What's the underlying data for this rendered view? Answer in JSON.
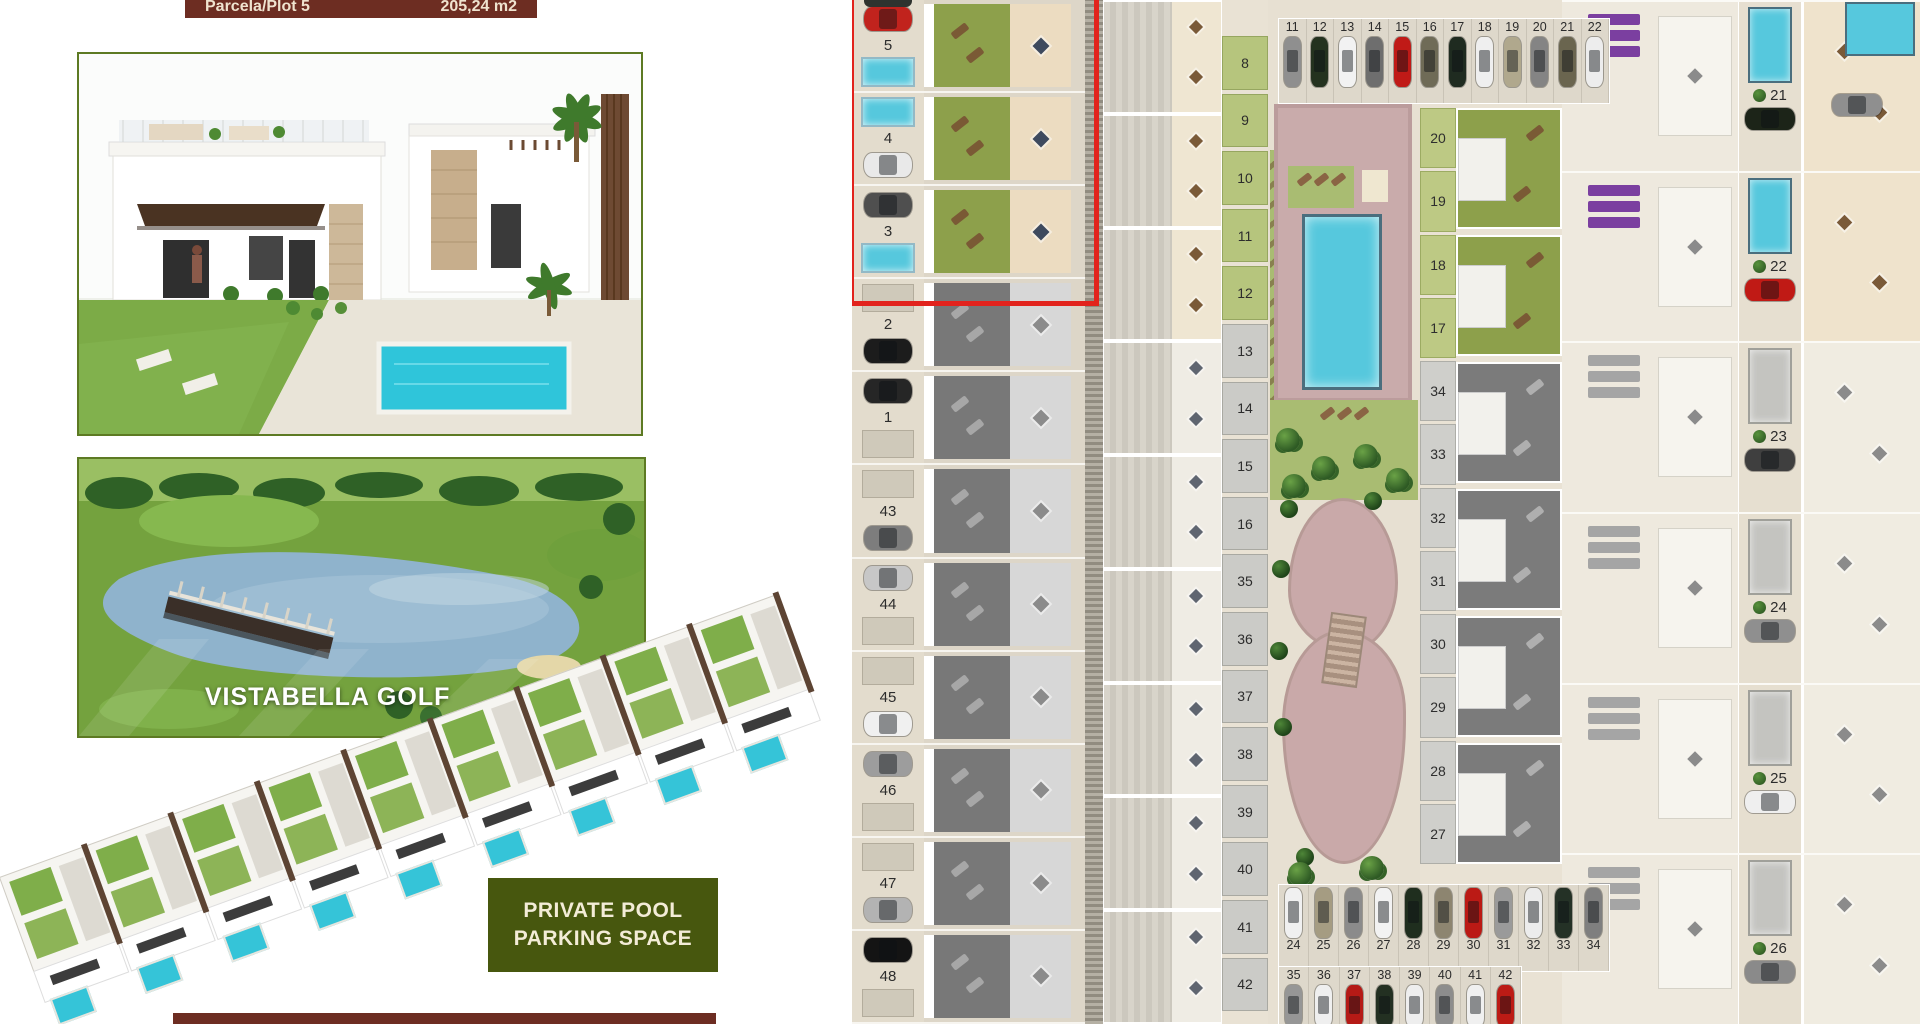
{
  "banners": {
    "top_left": "Parcela/Plot 5",
    "top_right": "205,24 m2"
  },
  "golf": {
    "caption": "VISTABELLA GOLF"
  },
  "green_box": {
    "line1": "PRIVATE POOL",
    "line2": "PARKING SPACE"
  },
  "colors": {
    "accent_red": "#e2231d",
    "banner_maroon": "#6d2d22",
    "photo_border_green": "#5d7a23",
    "pool_cyan": "#56c8dd",
    "garden_green": "#8da04b",
    "plot_cell_green": "#b6c57d",
    "lounger_purple": "#7b3fa0",
    "box_green": "#47570e"
  },
  "icons": {
    "car": "rounded-rect-with-glass",
    "pool": "cyan-rectangle",
    "tree": "green-circle-cluster",
    "lounger": "brown-bar",
    "table": "dark-diamond"
  },
  "plan": {
    "col_a": [
      {
        "label": "5",
        "hl": true,
        "top": "car",
        "bottom": "pool",
        "car": "#c1231d"
      },
      {
        "label": "4",
        "hl": true,
        "top": "pool",
        "bottom": "car",
        "car": "#e9e9e9"
      },
      {
        "label": "3",
        "hl": true,
        "top": "car",
        "bottom": "pool",
        "car": "#4f4f4f"
      },
      {
        "label": "2",
        "top": "pad",
        "bottom": "car",
        "car": "#1c1c1c"
      },
      {
        "label": "1",
        "top": "car",
        "bottom": "pad",
        "car": "#262626"
      },
      {
        "label": "43",
        "top": "pad",
        "bottom": "car",
        "car": "#7d7d7d"
      },
      {
        "label": "44",
        "top": "car",
        "bottom": "pad",
        "car": "#c7c7c7"
      },
      {
        "label": "45",
        "top": "pad",
        "bottom": "car",
        "car": "#f0f0f0"
      },
      {
        "label": "46",
        "top": "car",
        "bottom": "pad",
        "car": "#9d9d9d"
      },
      {
        "label": "47",
        "top": "pad",
        "bottom": "car",
        "car": "#b3b3b3"
      },
      {
        "label": "48",
        "top": "car",
        "bottom": "pad",
        "car": "#141414"
      }
    ],
    "col_b": [
      {
        "warm": true
      },
      {
        "warm": true
      },
      {
        "warm": true
      },
      {},
      {},
      {},
      {},
      {},
      {}
    ],
    "strip_b": [
      {
        "label": "8",
        "g": true
      },
      {
        "label": "9",
        "g": true
      },
      {
        "label": "10",
        "g": true
      },
      {
        "label": "11",
        "g": true
      },
      {
        "label": "12",
        "g": true
      },
      {
        "label": "13"
      },
      {
        "label": "14"
      },
      {
        "label": "15"
      },
      {
        "label": "16"
      },
      {
        "label": "35"
      },
      {
        "label": "36"
      },
      {
        "label": "37"
      },
      {
        "label": "38"
      },
      {
        "label": "39"
      },
      {
        "label": "40"
      },
      {
        "label": "41"
      },
      {
        "label": "42"
      }
    ],
    "top_parking": [
      {
        "label": "11",
        "car": "#8f8f8f"
      },
      {
        "label": "12",
        "car": "#24321f"
      },
      {
        "label": "13",
        "car": "#f2f2f2"
      },
      {
        "label": "14",
        "car": "#6e6e6e"
      },
      {
        "label": "15",
        "car": "#c01a17"
      },
      {
        "label": "16",
        "car": "#6f6b57"
      },
      {
        "label": "17",
        "car": "#1f2b20"
      },
      {
        "label": "18",
        "car": "#efefef"
      },
      {
        "label": "19",
        "car": "#b0a88d"
      },
      {
        "label": "20",
        "car": "#848484"
      },
      {
        "label": "21",
        "car": "#6a654f"
      },
      {
        "label": "22",
        "car": "#ededed"
      }
    ],
    "parking_24_34": [
      {
        "label": "24",
        "car": "#f0f0f0"
      },
      {
        "label": "25",
        "car": "#a59c82"
      },
      {
        "label": "26",
        "car": "#8b8b8b"
      },
      {
        "label": "27",
        "car": "#f2f2f2"
      },
      {
        "label": "28",
        "car": "#1f2e1e"
      },
      {
        "label": "29",
        "car": "#8d8570"
      },
      {
        "label": "30",
        "car": "#bb1a15"
      },
      {
        "label": "31",
        "car": "#9a9a9a"
      },
      {
        "label": "32",
        "car": "#ececec"
      },
      {
        "label": "33",
        "car": "#243126"
      },
      {
        "label": "34",
        "car": "#7f7f7f"
      }
    ],
    "parking_35_42": [
      {
        "label": "35",
        "car": "#969696"
      },
      {
        "label": "36",
        "car": "#efefef"
      },
      {
        "label": "37",
        "car": "#b51a16"
      },
      {
        "label": "38",
        "car": "#233022"
      },
      {
        "label": "39",
        "car": "#eeeeee"
      },
      {
        "label": "40",
        "car": "#8d8d8d"
      },
      {
        "label": "41",
        "car": "#f0f0f0"
      },
      {
        "label": "42",
        "car": "#bc1b15"
      }
    ],
    "strip_c": [
      {
        "label": "20",
        "g": true
      },
      {
        "label": "19",
        "g": true
      },
      {
        "label": "18",
        "g": true
      },
      {
        "label": "17",
        "g": true
      },
      {
        "label": "34"
      },
      {
        "label": "33"
      },
      {
        "label": "32"
      },
      {
        "label": "31"
      },
      {
        "label": "30"
      },
      {
        "label": "29"
      },
      {
        "label": "28"
      },
      {
        "label": "27"
      }
    ],
    "col_c_blocks": [
      {
        "hl": true
      },
      {
        "hl": true
      },
      {},
      {},
      {},
      {}
    ],
    "col_d": [
      {
        "label": "21",
        "hl": true,
        "car": "#1c2418"
      },
      {
        "label": "22",
        "hl": true,
        "car": "#c01a15"
      },
      {
        "label": "23",
        "car": "#3f3f3f"
      },
      {
        "label": "24",
        "car": "#8f8f8f"
      },
      {
        "label": "25",
        "car": "#efefef"
      },
      {
        "label": "26",
        "car": "#8a8a8a"
      }
    ]
  }
}
